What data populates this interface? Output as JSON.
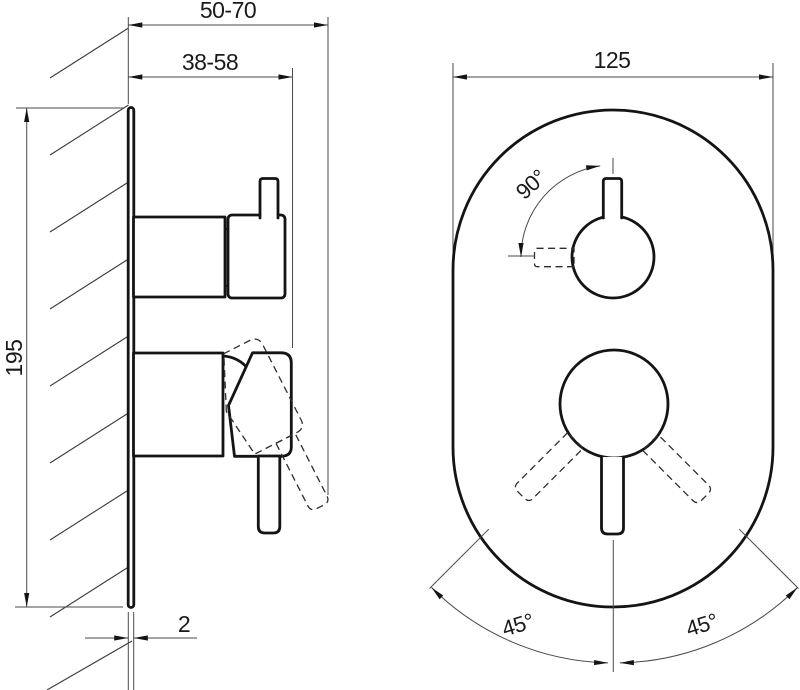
{
  "drawing": {
    "kind": "concealed-shower-mixer-installation-diagram",
    "dimensions": {
      "outer_depth_range": "50-70",
      "inner_depth_range": "38-58",
      "body_height": "195",
      "plate_thickness": "2",
      "faceplate_width": "125",
      "top_handle_angle": "90°",
      "lever_angle_left": "45°",
      "lever_angle_right": "45°"
    },
    "colors": {
      "outline": "#141414",
      "dimension_line": "#4a4a4a",
      "dashed_line": "#2e2e2e",
      "background": "#ffffff"
    }
  }
}
